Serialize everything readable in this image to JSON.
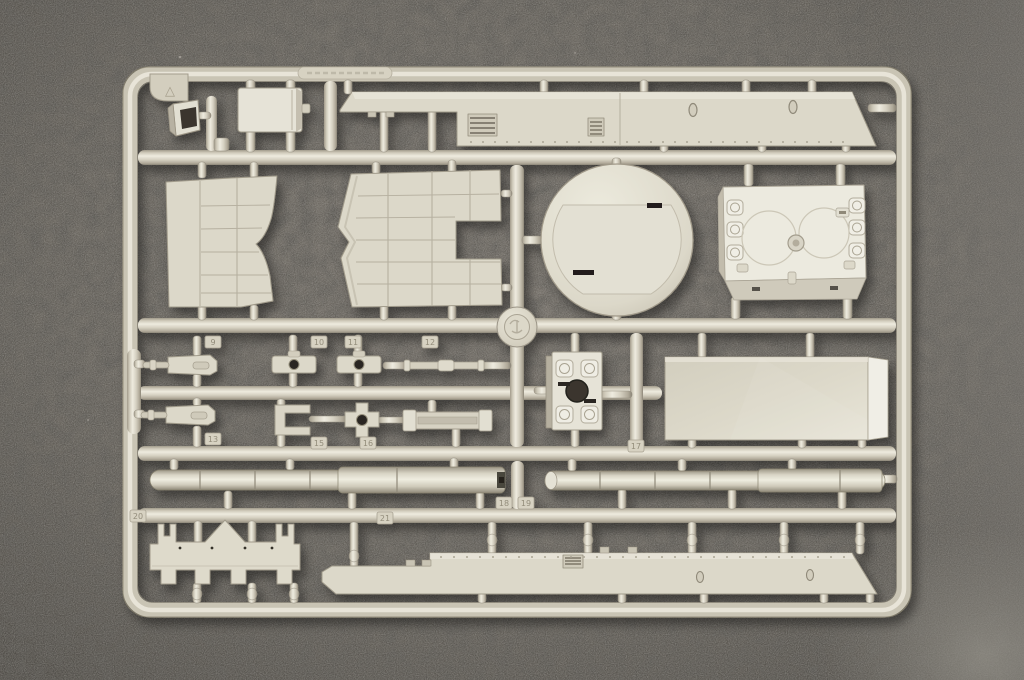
{
  "scene": {
    "description": "Light grey injection-moulded plastic model-kit sprue (parts tree) with tank hull panels, turret ring disc, gun barrel halves and small fittings, photographed on a dark grey felt mat"
  },
  "colors": {
    "background_base": "#67635c",
    "background_shadowed": "#4b4843",
    "background_light_patch": "#8d8a82",
    "sprue_plastic": "#d6d1c1",
    "sprue_highlight": "#efece0",
    "sprue_shadow": "#8f897b",
    "part_face": "#dcd8c9",
    "part_bright": "#eeece4",
    "part_side": "#b7b1a2",
    "slot_dark": "#2b2823"
  },
  "markings": {
    "corner_triangle": "△",
    "runner_plate": "embossed maker text (illegible)",
    "medallion": "embossed circular logo boss"
  },
  "part_tags": [
    {
      "number": "9",
      "x": 205,
      "y": 336
    },
    {
      "number": "10",
      "x": 311,
      "y": 336
    },
    {
      "number": "11",
      "x": 345,
      "y": 336
    },
    {
      "number": "12",
      "x": 422,
      "y": 336
    },
    {
      "number": "13",
      "x": 205,
      "y": 433
    },
    {
      "number": "15",
      "x": 311,
      "y": 437
    },
    {
      "number": "16",
      "x": 360,
      "y": 437
    },
    {
      "number": "17",
      "x": 628,
      "y": 440
    },
    {
      "number": "18",
      "x": 496,
      "y": 497
    },
    {
      "number": "19",
      "x": 518,
      "y": 497
    },
    {
      "number": "20",
      "x": 130,
      "y": 510
    },
    {
      "number": "21",
      "x": 377,
      "y": 512
    }
  ],
  "parts": [
    "corner-tab",
    "periscope-block",
    "hatch-panel",
    "hull-side-strip-top",
    "side-skirt-panel-left",
    "side-skirt-panel-right",
    "turret-ring-disc",
    "hull-roof-box",
    "gun-mount-wedge-1",
    "gun-mount-wedge-2",
    "hole-block-1",
    "hole-block-2",
    "linkage-rod",
    "u-bracket",
    "cross-hub",
    "channel-strip",
    "turret-base-block",
    "rear-panel",
    "gun-barrel-half-upper",
    "gun-barrel-half-lower",
    "belly-plate",
    "hull-side-strip-bottom",
    "sprue-medallion"
  ]
}
